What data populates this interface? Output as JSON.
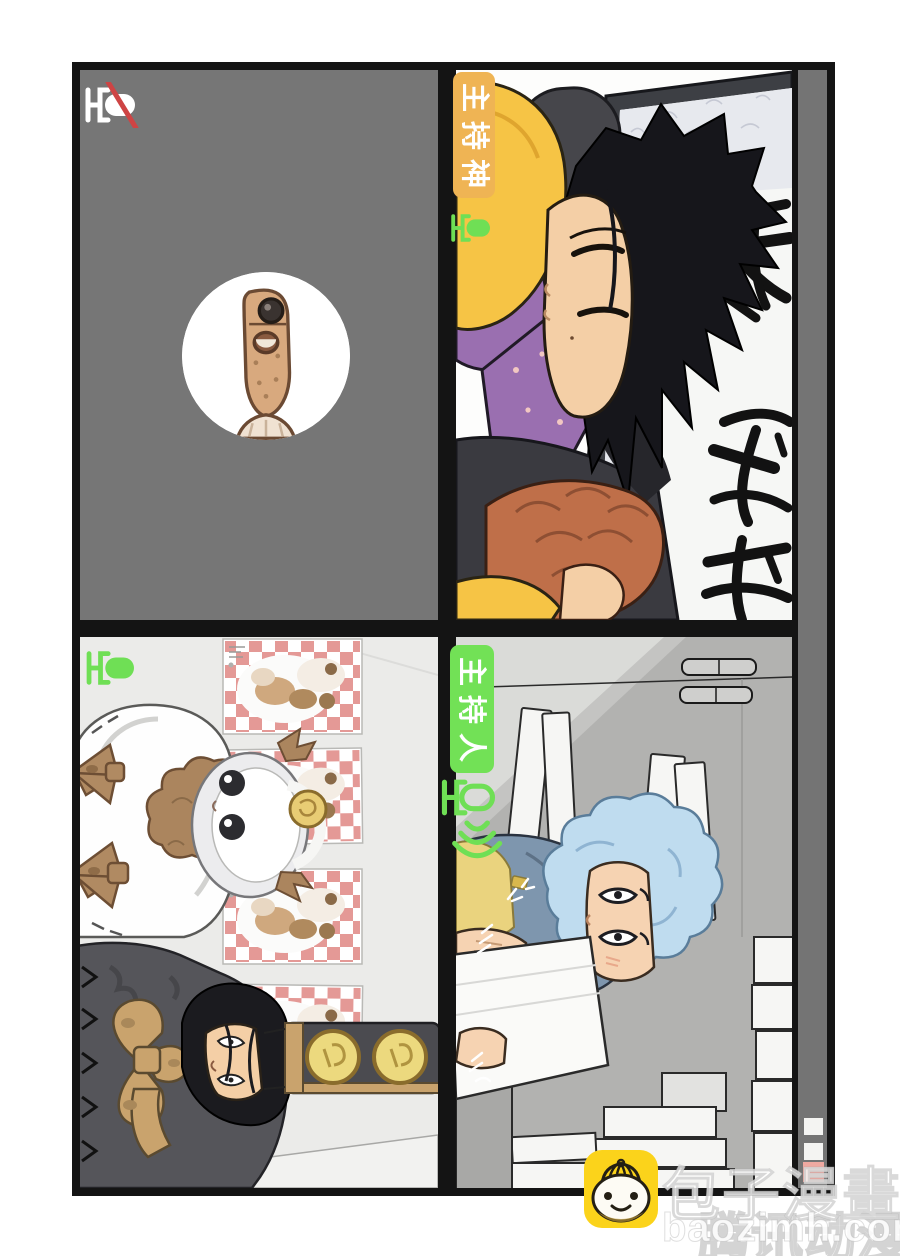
{
  "video_call": {
    "labels": {
      "top_right": "主持神",
      "bottom_right": "主持人"
    },
    "mic_states": {
      "top_left": "muted",
      "top_right": "on",
      "bottom_left": "on",
      "bottom_right": "speaking"
    },
    "icons": {
      "top_left": "mic-muted-icon",
      "top_right": "mic-on-icon",
      "bottom_left": "mic-on-icon",
      "bottom_right": "mic-speaking-icon"
    },
    "colors": {
      "mic_green": "#6fdf55",
      "mic_muted_white": "#ffffff",
      "mute_slash_red": "#ce4444",
      "label_yellow": "#efb454",
      "label_green": "#72e156",
      "panel_gray": "#767676",
      "sidebar_gray": "#747474",
      "sidebar_button_pink": "#efa9a1"
    }
  },
  "watermark": {
    "brand": "包子漫畫",
    "domain": "baozimh.com",
    "ghost_text": "腾讯动漫",
    "mascot_icon": "baozi-bun-icon",
    "mascot_color": "#fbd31b"
  }
}
